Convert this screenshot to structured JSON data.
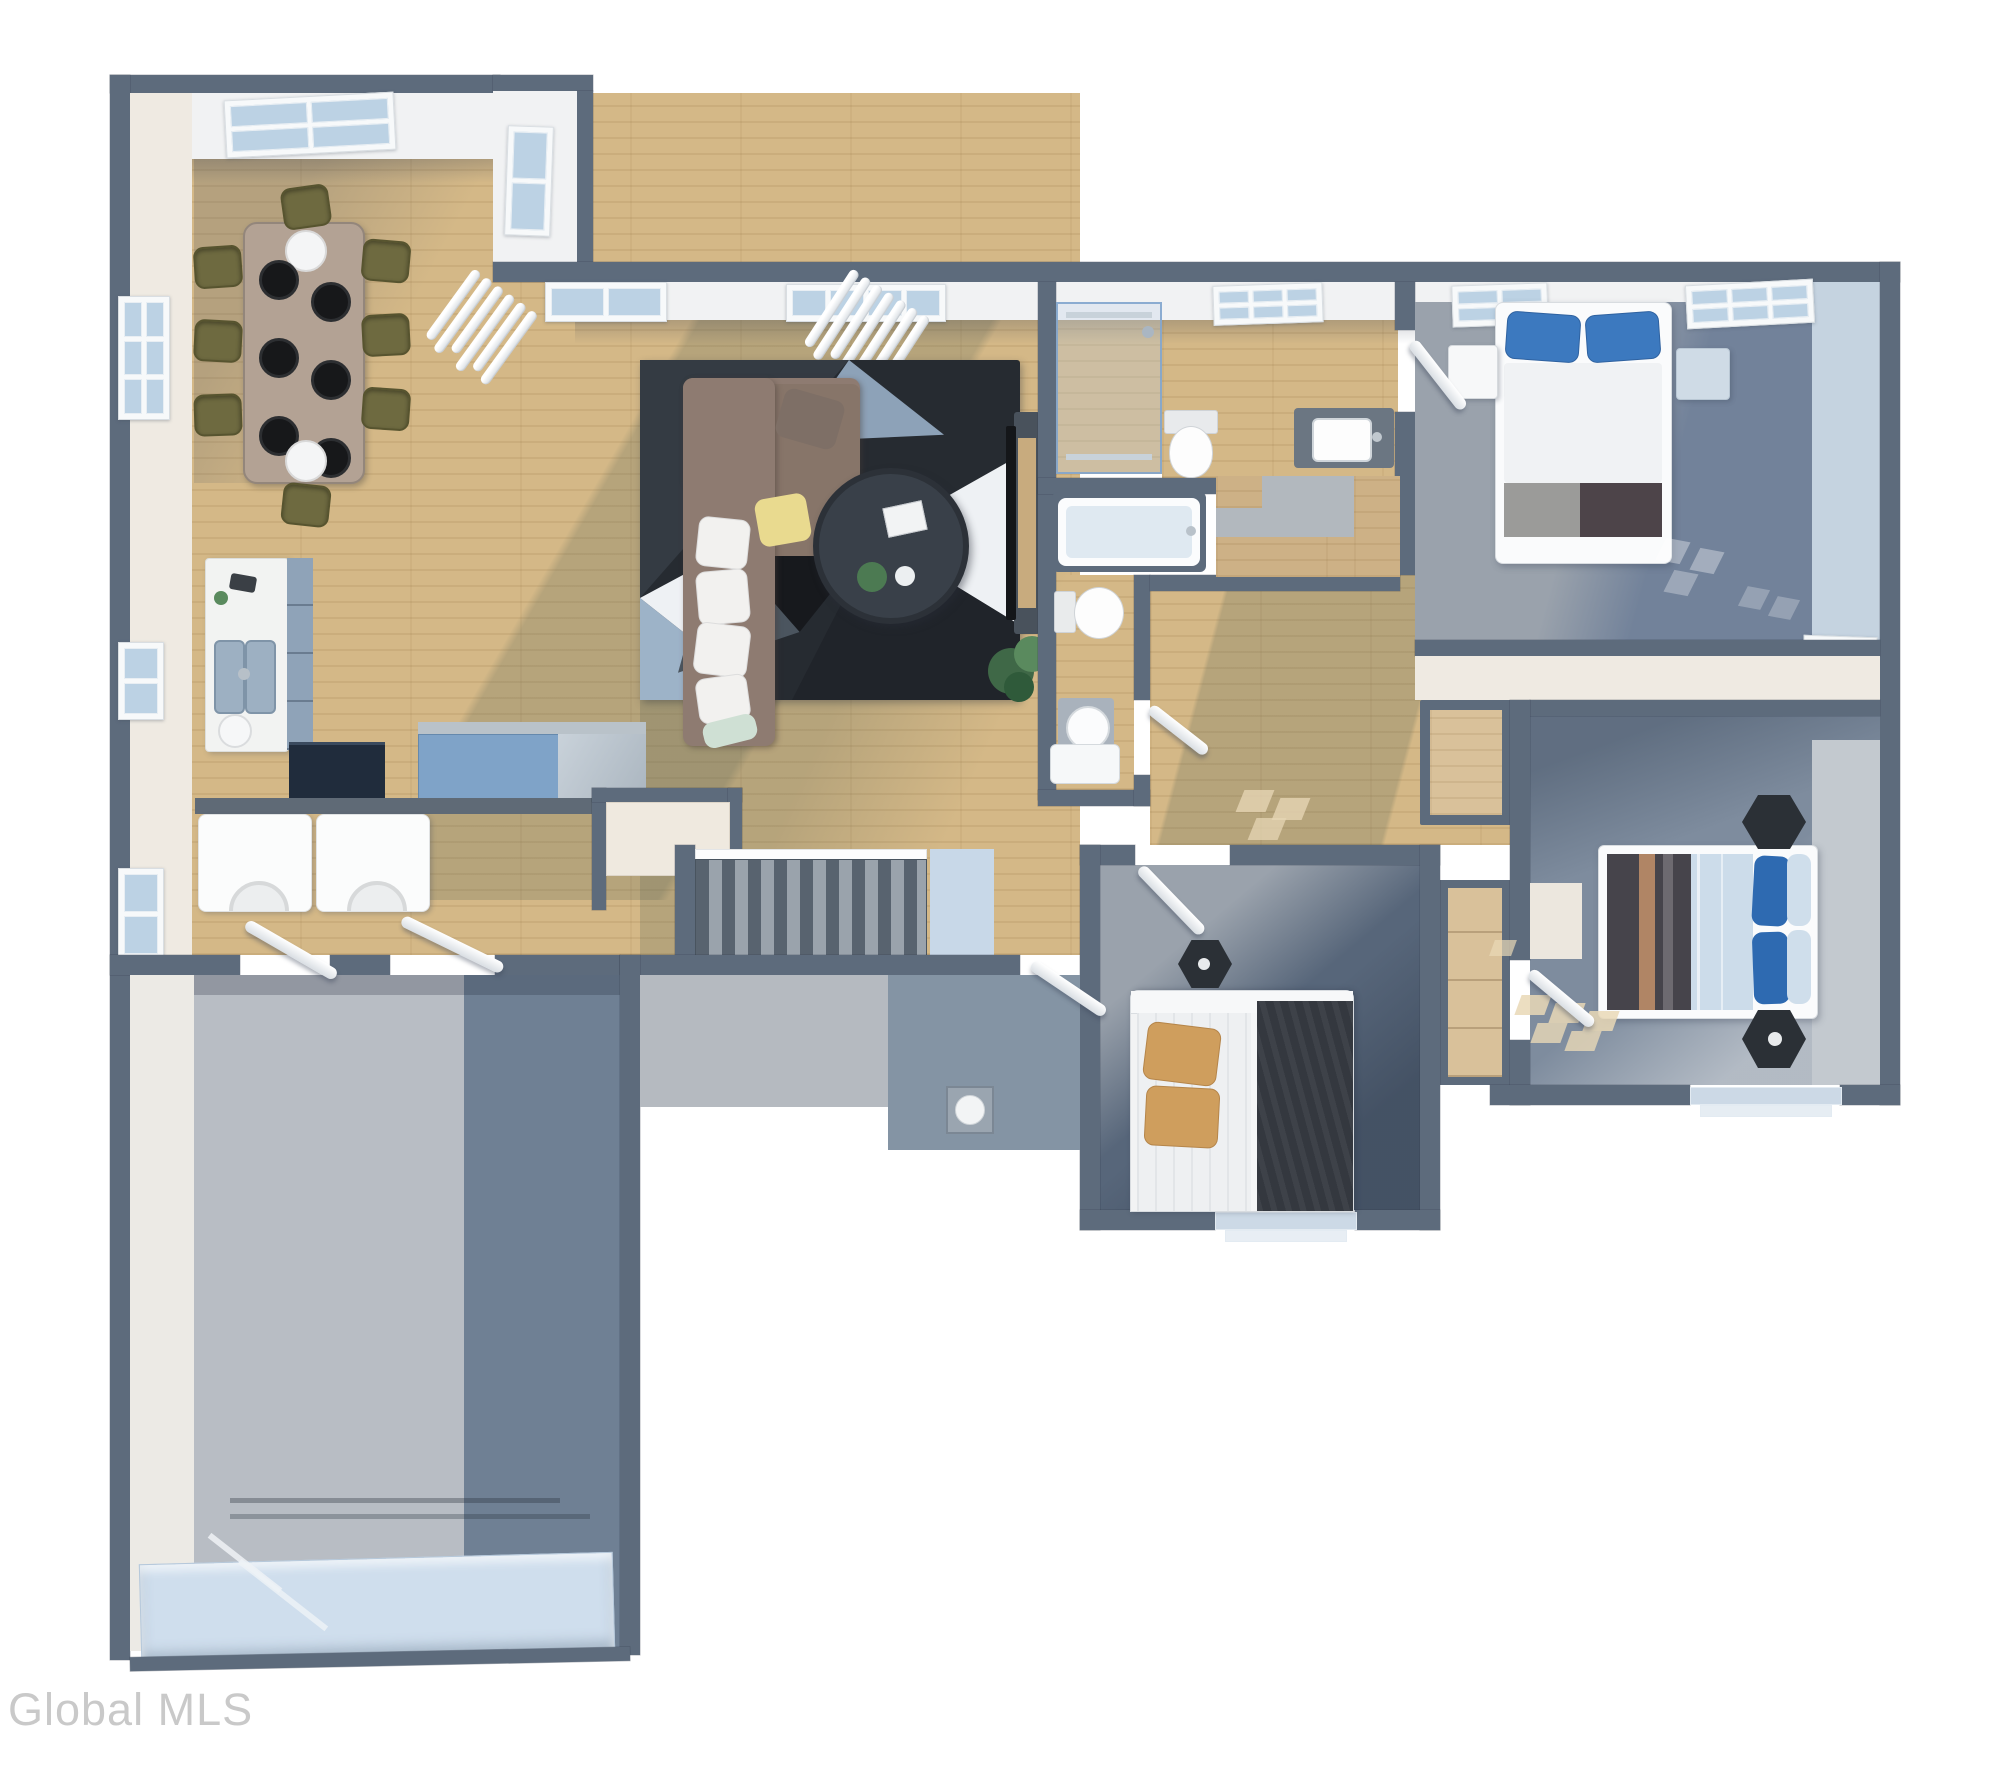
{
  "watermark": {
    "text": "Global MLS"
  },
  "palette": {
    "wall": "#5d6b7c",
    "wall-dark": "#4a5866",
    "face-white": "#f1f2f3",
    "face-cream": "#efeae2",
    "face-blue": "#c5d3e0",
    "wood": "#d4b887",
    "wood-light": "#dfc79b",
    "glass": "#bcd2e4",
    "sill-blue": "#ccd9e6",
    "shadow-olive": "rgba(96,105,88,0.26)",
    "rug-base": "#262b31",
    "rug-charcoal": "#343b43",
    "rug-black": "#17191d",
    "rug-slate": "#8da2b8",
    "rug-lightblue": "#9db3c8",
    "rug-white": "#eef1f4",
    "sofa": "#8e7b71",
    "sofa-dark": "#877569",
    "pillow-white": "#f2f1ef",
    "pillow-yellow": "#e9da8f",
    "pillow-mint": "#cfe0d4",
    "coffee-table": "#394049",
    "carpet-master": "#72829a",
    "carpet-light": "#9aa2ac",
    "carpet-bedroom2": "#7e8c9e",
    "carpet-bedroom3": "#57667a",
    "concrete-light": "#b8bdc4",
    "concrete-dark": "#6f8094",
    "porch-light": "#b5bac0",
    "porch-dark": "#8494a4",
    "garage-door": "#cfdeed",
    "blue-pillow": "#3c79bf",
    "royal-pillow": "#2e6ab1",
    "duvet-pale": "#ccdcea",
    "tan-pillow": "#cf9e5d",
    "blanket-dark": "#34383f",
    "blanket-brown": "#46444b",
    "night-white": "#f7f8f9",
    "night-blue": "#cfdbe6",
    "hex": "#2b3036",
    "counter-white": "#f2f3f2",
    "cabinet-blue": "#8fa3b8",
    "island-blue": "#7fa3c8",
    "appliance-navy": "#202c3c",
    "chair-olive": "#6e6a40",
    "table-wood": "#b3a294",
    "bench": "#efe9df",
    "mat-blue": "#c8d8e8",
    "watermark": "#c9c9c9"
  }
}
